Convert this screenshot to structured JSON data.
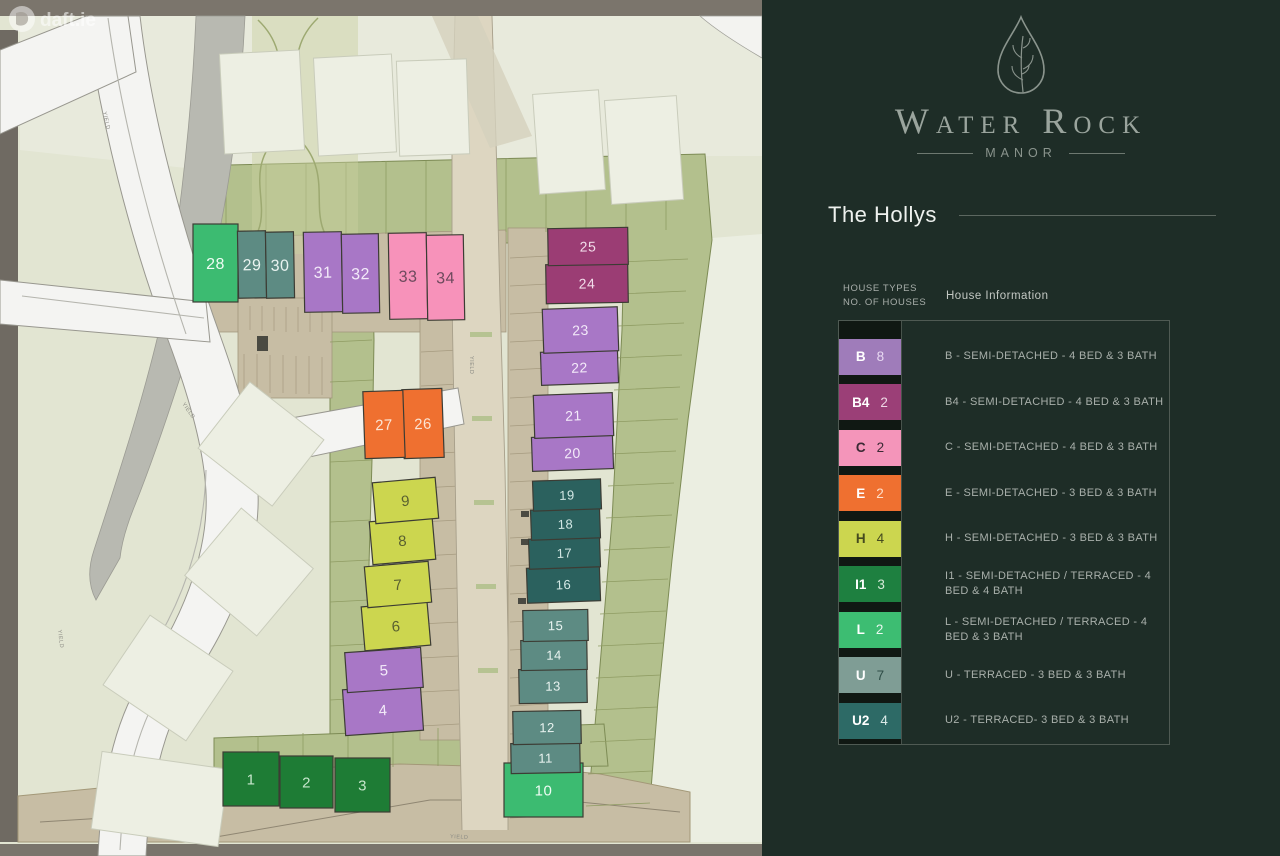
{
  "watermark": {
    "text": "daft.ie"
  },
  "brand": {
    "name": "Water Rock",
    "subtitle": "MANOR",
    "logo_icon": "water-drop-with-leaves",
    "color": "#9aa49d"
  },
  "section": {
    "title": "The Hollys"
  },
  "legend": {
    "header_line1": "HOUSE TYPES",
    "header_line2": "NO. OF HOUSES",
    "header_right": "House Information",
    "rows": [
      {
        "code": "B",
        "count": "8",
        "color": "#9f7cba",
        "label_color": "#ffffff",
        "count_color": "#e8d9f2",
        "desc": "B - SEMI-DETACHED - 4 BED & 3 BATH"
      },
      {
        "code": "B4",
        "count": "2",
        "color": "#9b3f77",
        "label_color": "#ffffff",
        "count_color": "#eed7e5",
        "desc": "B4 - SEMI-DETACHED - 4 BED & 3 BATH"
      },
      {
        "code": "C",
        "count": "2",
        "color": "#f495ba",
        "label_color": "#3a2a34",
        "count_color": "#3a2a34",
        "desc": "C - SEMI-DETACHED - 4 BED & 3 BATH"
      },
      {
        "code": "E",
        "count": "2",
        "color": "#ef7030",
        "label_color": "#ffffff",
        "count_color": "#ffdfca",
        "desc": "E - SEMI-DETACHED  - 3 BED & 3 BATH"
      },
      {
        "code": "H",
        "count": "4",
        "color": "#ccd64f",
        "label_color": "#454a1f",
        "count_color": "#454a1f",
        "desc": "H - SEMI-DETACHED - 3 BED & 3 BATH"
      },
      {
        "code": "I1",
        "count": "3",
        "color": "#1e8040",
        "label_color": "#ffffff",
        "count_color": "#d6ead9",
        "desc": "I1 - SEMI-DETACHED / TERRACED - 4 BED & 4 BATH"
      },
      {
        "code": "L",
        "count": "2",
        "color": "#3dbd72",
        "label_color": "#ffffff",
        "count_color": "#e8f7ee",
        "desc": "L - SEMI-DETACHED / TERRACED - 4 BED & 3  BATH"
      },
      {
        "code": "U",
        "count": "7",
        "color": "#7f9d95",
        "label_color": "#ffffff",
        "count_color": "#2f4d47",
        "desc": "U - TERRACED - 3 BED & 3 BATH"
      },
      {
        "code": "U2",
        "count": "4",
        "color": "#2d6a66",
        "label_color": "#ffffff",
        "count_color": "#dbeae8",
        "desc": "U2 - TERRACED- 3 BED & 3 BATH"
      }
    ]
  },
  "site_plan": {
    "yield_label": "YIELD",
    "house_fill": {
      "B": "#a877c6",
      "B4": "#9b3d74",
      "C": "#f792ba",
      "E": "#ef7030",
      "H": "#ccd64f",
      "I1": "#1e7c35",
      "L": "#3cbb71",
      "U": "#5d8b83",
      "U2": "#2b615e"
    },
    "house_number_color": {
      "B": "#f3eaf9",
      "B4": "#f2dcea",
      "C": "#6d4a5d",
      "E": "#fce4d3",
      "H": "#596030",
      "I1": "#c5e6cb",
      "L": "#eefcf3",
      "U": "#e9f3f0",
      "U2": "#d2e7e4"
    },
    "house_outline": "#3c3c34",
    "houses": [
      {
        "no": "1",
        "type": "I1",
        "x": 223,
        "y": 752,
        "w": 56,
        "h": 54,
        "r": 0,
        "fs": 15
      },
      {
        "no": "2",
        "type": "I1",
        "x": 280,
        "y": 756,
        "w": 53,
        "h": 52,
        "r": 0,
        "fs": 15
      },
      {
        "no": "3",
        "type": "I1",
        "x": 335,
        "y": 758,
        "w": 55,
        "h": 54,
        "r": 0,
        "fs": 15
      },
      {
        "no": "4",
        "type": "B",
        "x": 344,
        "y": 687,
        "w": 78,
        "h": 46,
        "r": -4,
        "fs": 15
      },
      {
        "no": "5",
        "type": "B",
        "x": 346,
        "y": 650,
        "w": 76,
        "h": 40,
        "r": -4,
        "fs": 15
      },
      {
        "no": "6",
        "type": "H",
        "x": 363,
        "y": 604,
        "w": 66,
        "h": 44,
        "r": -5,
        "fs": 15
      },
      {
        "no": "7",
        "type": "H",
        "x": 366,
        "y": 564,
        "w": 64,
        "h": 41,
        "r": -5,
        "fs": 15
      },
      {
        "no": "8",
        "type": "H",
        "x": 371,
        "y": 519,
        "w": 63,
        "h": 43,
        "r": -5,
        "fs": 15
      },
      {
        "no": "9",
        "type": "H",
        "x": 374,
        "y": 480,
        "w": 63,
        "h": 41,
        "r": -5,
        "fs": 15
      },
      {
        "no": "10",
        "type": "L",
        "x": 504,
        "y": 763,
        "w": 79,
        "h": 54,
        "r": 0,
        "fs": 15
      },
      {
        "no": "11",
        "type": "U",
        "x": 511,
        "y": 743,
        "w": 69,
        "h": 30,
        "r": -1,
        "fs": 13
      },
      {
        "no": "12",
        "type": "U",
        "x": 513,
        "y": 711,
        "w": 68,
        "h": 33,
        "r": -1,
        "fs": 13
      },
      {
        "no": "13",
        "type": "U",
        "x": 519,
        "y": 669,
        "w": 68,
        "h": 34,
        "r": -1,
        "fs": 13
      },
      {
        "no": "14",
        "type": "U",
        "x": 521,
        "y": 640,
        "w": 66,
        "h": 30,
        "r": -1,
        "fs": 13
      },
      {
        "no": "15",
        "type": "U",
        "x": 523,
        "y": 610,
        "w": 65,
        "h": 31,
        "r": -1,
        "fs": 13
      },
      {
        "no": "16",
        "type": "U2",
        "x": 527,
        "y": 567,
        "w": 73,
        "h": 35,
        "r": -2,
        "fs": 13
      },
      {
        "no": "17",
        "type": "U2",
        "x": 529,
        "y": 538,
        "w": 71,
        "h": 30,
        "r": -2,
        "fs": 13
      },
      {
        "no": "18",
        "type": "U2",
        "x": 531,
        "y": 509,
        "w": 69,
        "h": 30,
        "r": -2,
        "fs": 13
      },
      {
        "no": "19",
        "type": "U2",
        "x": 533,
        "y": 480,
        "w": 68,
        "h": 30,
        "r": -2,
        "fs": 13
      },
      {
        "no": "20",
        "type": "B",
        "x": 532,
        "y": 436,
        "w": 81,
        "h": 34,
        "r": -2,
        "fs": 14
      },
      {
        "no": "21",
        "type": "B",
        "x": 534,
        "y": 394,
        "w": 79,
        "h": 43,
        "r": -2,
        "fs": 14
      },
      {
        "no": "22",
        "type": "B",
        "x": 541,
        "y": 351,
        "w": 77,
        "h": 33,
        "r": -2,
        "fs": 14
      },
      {
        "no": "23",
        "type": "B",
        "x": 543,
        "y": 308,
        "w": 75,
        "h": 44,
        "r": -2,
        "fs": 14
      },
      {
        "no": "24",
        "type": "B4",
        "x": 546,
        "y": 264,
        "w": 82,
        "h": 39,
        "r": -1,
        "fs": 14
      },
      {
        "no": "25",
        "type": "B4",
        "x": 548,
        "y": 228,
        "w": 80,
        "h": 37,
        "r": -1,
        "fs": 14
      },
      {
        "no": "26",
        "type": "E",
        "x": 403,
        "y": 389,
        "w": 40,
        "h": 69,
        "r": -2,
        "fs": 15
      },
      {
        "no": "27",
        "type": "E",
        "x": 364,
        "y": 391,
        "w": 40,
        "h": 67,
        "r": -2,
        "fs": 15
      },
      {
        "no": "28",
        "type": "L",
        "x": 193,
        "y": 224,
        "w": 45,
        "h": 78,
        "r": 0,
        "fs": 16
      },
      {
        "no": "29",
        "type": "U",
        "x": 238,
        "y": 231,
        "w": 28,
        "h": 67,
        "r": -1,
        "fs": 16
      },
      {
        "no": "30",
        "type": "U",
        "x": 266,
        "y": 232,
        "w": 28,
        "h": 66,
        "r": -1,
        "fs": 16
      },
      {
        "no": "31",
        "type": "B",
        "x": 304,
        "y": 232,
        "w": 38,
        "h": 80,
        "r": -1,
        "fs": 16
      },
      {
        "no": "32",
        "type": "B",
        "x": 342,
        "y": 234,
        "w": 37,
        "h": 79,
        "r": -1,
        "fs": 16
      },
      {
        "no": "33",
        "type": "C",
        "x": 389,
        "y": 233,
        "w": 38,
        "h": 86,
        "r": -1,
        "fs": 16
      },
      {
        "no": "34",
        "type": "C",
        "x": 427,
        "y": 235,
        "w": 37,
        "h": 85,
        "r": -1,
        "fs": 16
      }
    ]
  }
}
